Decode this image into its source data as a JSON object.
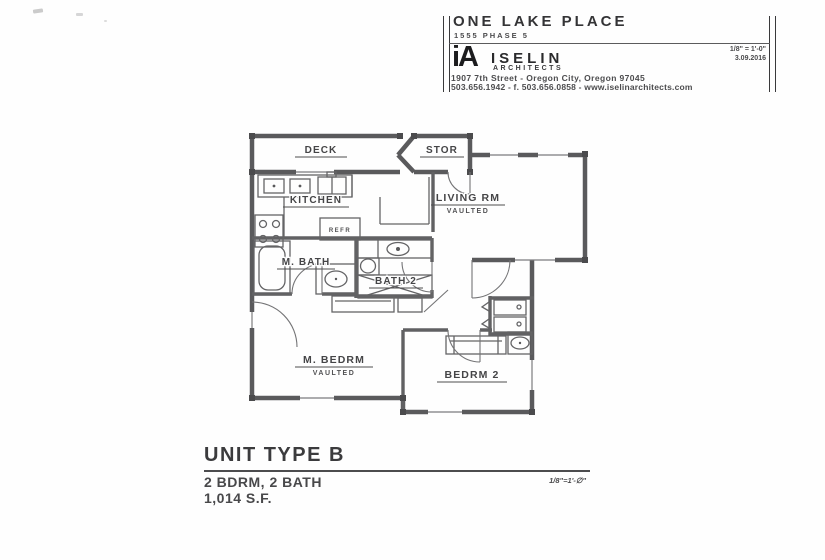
{
  "colors": {
    "ink": "#3f3f41",
    "wall": "#5a5a5c",
    "paper": "#fefefe"
  },
  "title_block": {
    "project_name": "ONE LAKE PLACE",
    "project_phase": "1555 PHASE 5",
    "scale": "1/8\" = 1'-0\"",
    "date": "3.09.2016",
    "firm": {
      "logo": "iA",
      "name": "ISELIN",
      "discipline": "ARCHITECTS",
      "address": "1907 7th Street - Oregon City, Oregon 97045",
      "contact": "503.656.1942 - f. 503.656.0858 - www.iselinarchitects.com"
    }
  },
  "plan": {
    "rooms": {
      "deck": "DECK",
      "stor": "STOR",
      "kitchen": "KITCHEN",
      "living": "LIVING RM",
      "living_note": "VAULTED",
      "m_bath": "M. BATH",
      "bath2": "BATH 2",
      "m_bedrm": "M. BEDRM",
      "m_bedrm_note": "VAULTED",
      "bedrm2": "BEDRM 2"
    },
    "fixtures": {
      "refr": "REFR"
    }
  },
  "footer": {
    "unit_type": "UNIT TYPE B",
    "specs_line1": "2 BDRM, 2 BATH",
    "specs_line2": "1,014 S.F.",
    "scale": "1/8\"=1'-∅\""
  }
}
